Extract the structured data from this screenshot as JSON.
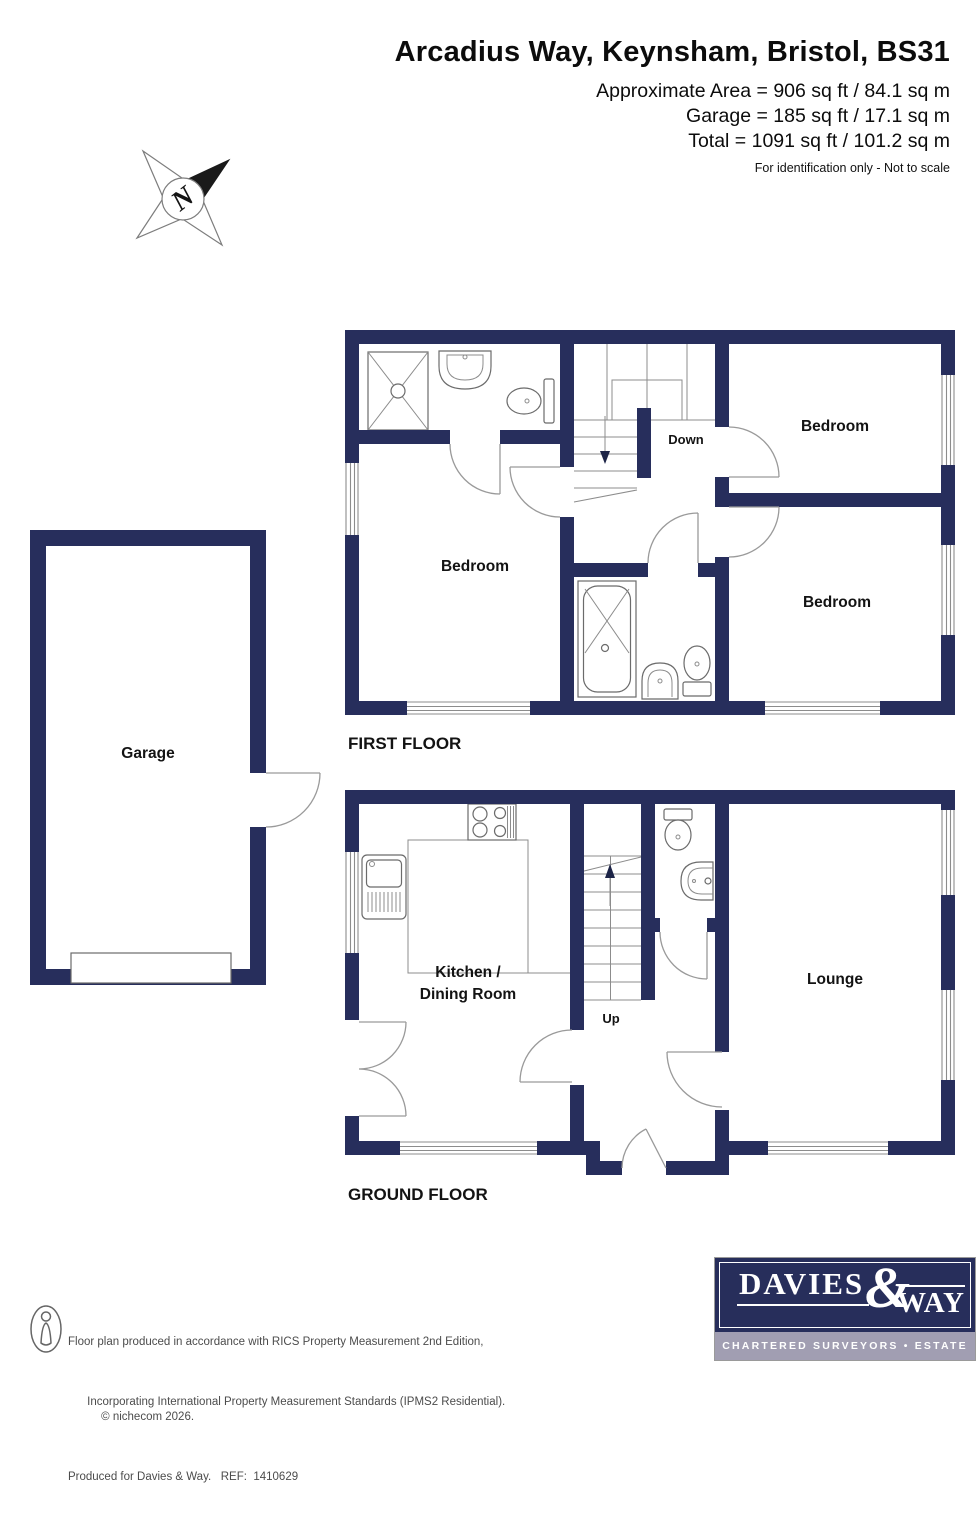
{
  "header": {
    "title": "Arcadius Way, Keynsham, Bristol, BS31",
    "area_line1": "Approximate Area = 906 sq ft / 84.1 sq m",
    "area_line2": "Garage = 185 sq ft / 17.1 sq m",
    "area_line3": "Total = 1091 sq ft / 101.2 sq m",
    "disclaimer": "For identification only - Not to scale"
  },
  "compass": {
    "north_label": "N"
  },
  "first_floor": {
    "title": "FIRST FLOOR",
    "bedroom_main": "Bedroom",
    "bedroom_top_right": "Bedroom",
    "bedroom_right": "Bedroom",
    "stair_label": "Down"
  },
  "garage": {
    "room_label": "Garage"
  },
  "ground_floor": {
    "title": "GROUND FLOOR",
    "kitchen_line1": "Kitchen /",
    "kitchen_line2": "Dining Room",
    "lounge": "Lounge",
    "stair_label": "Up"
  },
  "footer": {
    "line1": "Floor plan produced in accordance with RICS Property Measurement 2nd Edition,",
    "line2": "Incorporating International Property Measurement Standards (IPMS2 Residential).",
    "copyright": "© nichecom 2026.",
    "line3": "Produced for Davies & Way.   REF:  1410629",
    "logo": {
      "name_part1": "DAVIES",
      "ampersand": "&",
      "name_part2": "WAY",
      "tagline": "CHARTERED SURVEYORS • ESTATE AGENTS"
    }
  },
  "colors": {
    "wall": "#272e5c",
    "logo_navy": "#272e5b",
    "logo_strip": "#a19eb2"
  }
}
